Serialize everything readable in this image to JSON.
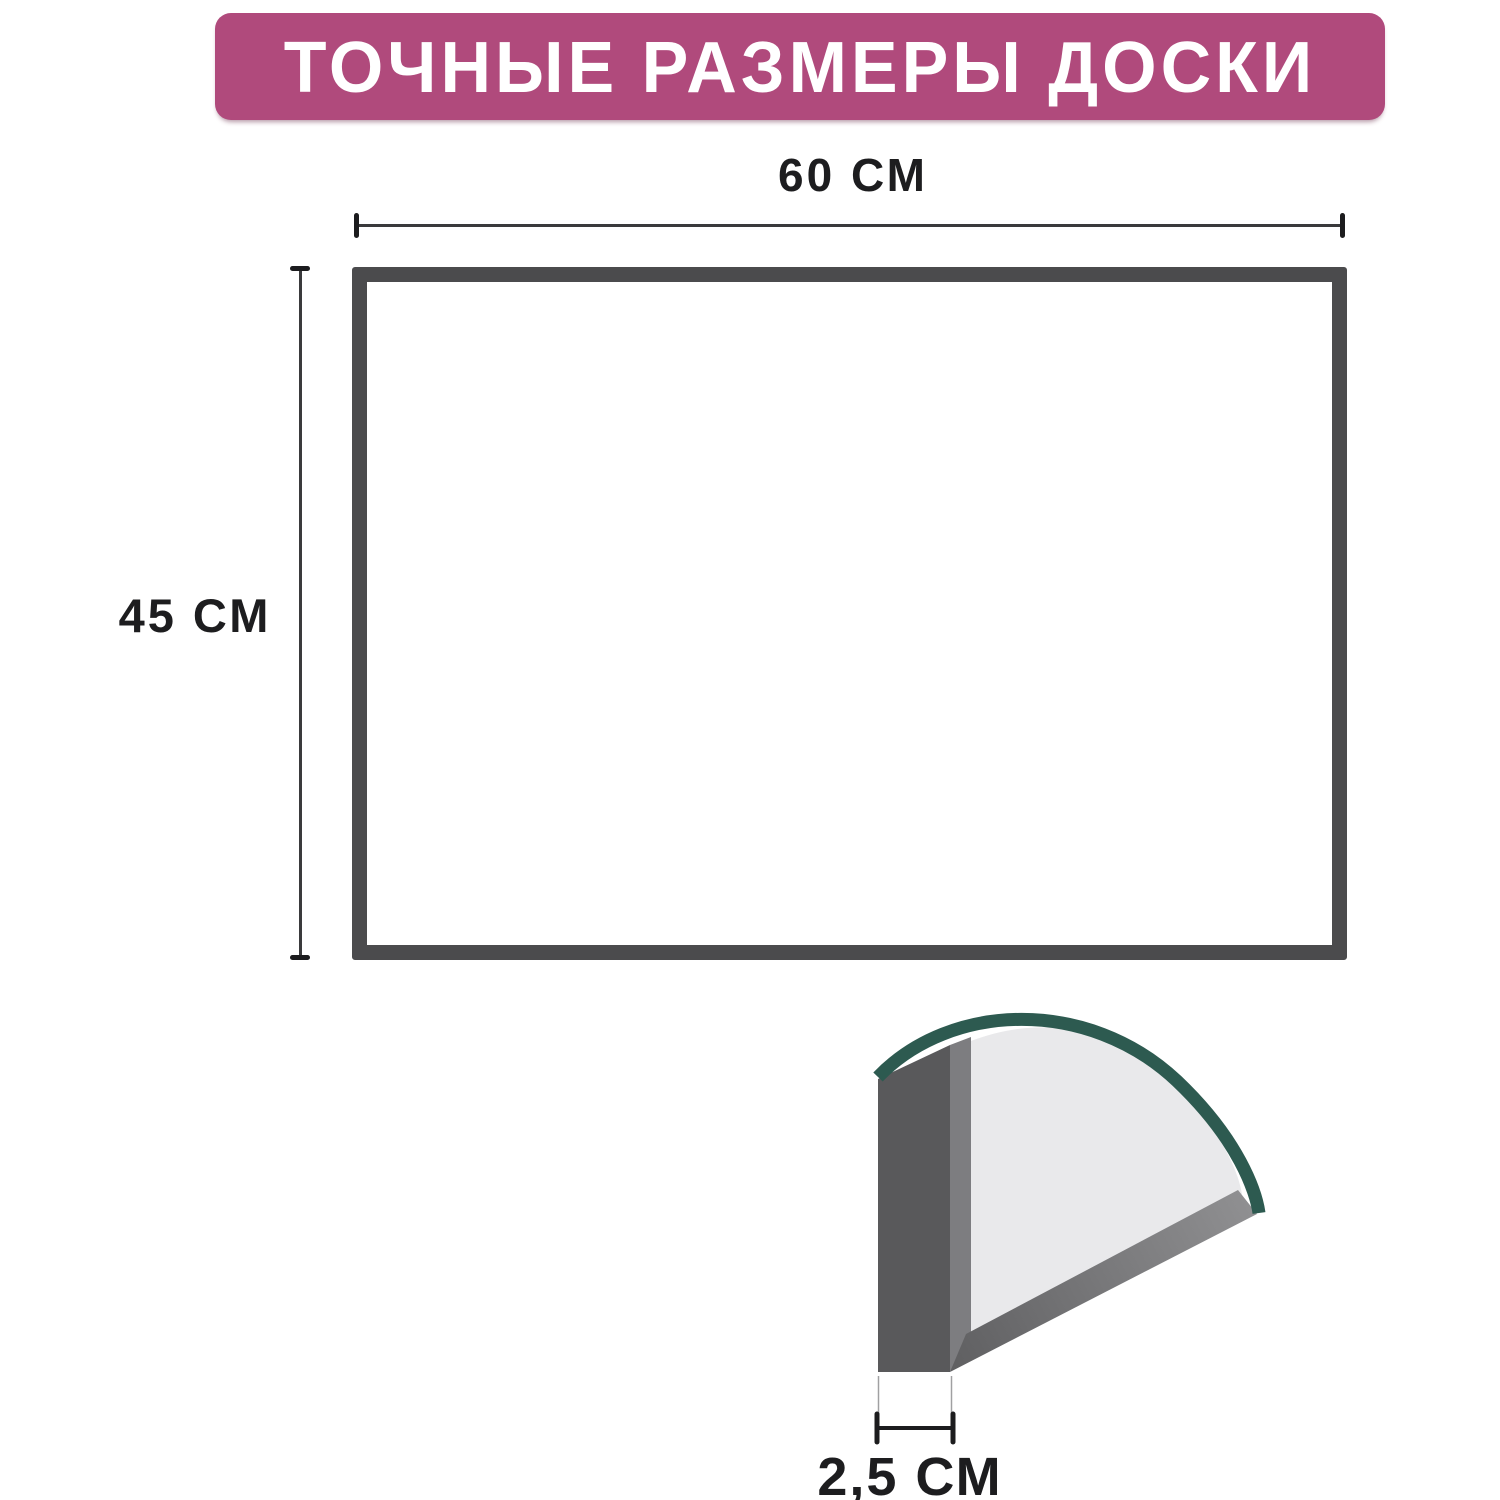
{
  "title": {
    "text": "ТОЧНЫЕ РАЗМЕРЫ ДОСКИ"
  },
  "dimensions": {
    "width": {
      "label": "60 СМ",
      "value": 60,
      "unit": "см"
    },
    "height": {
      "label": "45 СМ",
      "value": 45,
      "unit": "см"
    },
    "thickness": {
      "label": "2,5 СМ",
      "value": 2.5,
      "unit": "см"
    }
  },
  "colors": {
    "background": "#ffffff",
    "banner_bg": "#b04a7c",
    "banner_text": "#ffffff",
    "board_frame": "#4b4b4d",
    "board_fill": "#ffffff",
    "dimension_line": "#3a3a3c",
    "dimension_tick": "#1c1c1e",
    "label_text": "#1d1d1f",
    "profile_dark": "#59595b",
    "profile_mid": "#7d7d80",
    "surface_light": "#e9e9eb",
    "bottom_edge_start": "#5f5f61",
    "bottom_edge_end": "#8f8f91",
    "edge_arc_teal": "#2d5a50",
    "extension_line": "#a0a0a2"
  }
}
